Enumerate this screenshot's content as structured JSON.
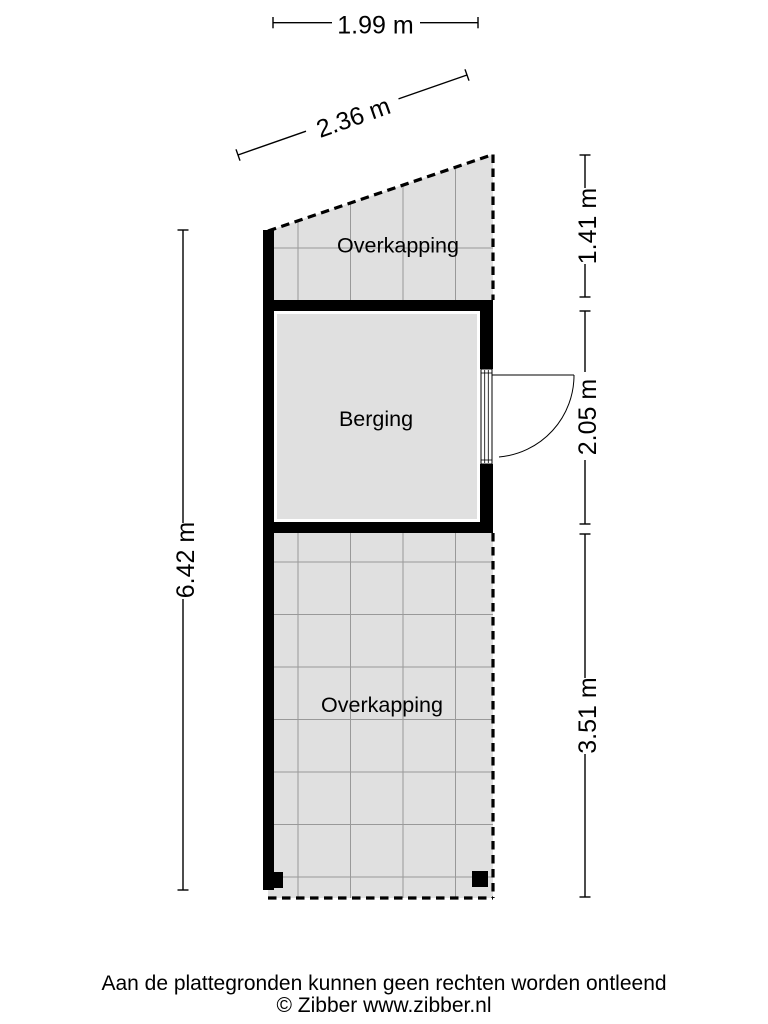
{
  "floorplan": {
    "rooms": {
      "top": "Overkapping",
      "middle": "Berging",
      "bottom": "Overkapping"
    },
    "dimensions": {
      "top_width": "1.99 m",
      "slanted_edge": "2.36 m",
      "right_top": "1.41 m",
      "right_middle": "2.05 m",
      "right_bottom": "3.51 m",
      "left_height": "6.42 m"
    }
  },
  "footer": {
    "disclaimer": "Aan de plattegronden kunnen geen rechten worden ontleend",
    "copyright": "© Zibber www.zibber.nl"
  },
  "colors": {
    "background": "#ffffff",
    "room_fill": "#e0e0e0",
    "wall": "#000000",
    "grid_line": "#999999",
    "text": "#000000"
  }
}
